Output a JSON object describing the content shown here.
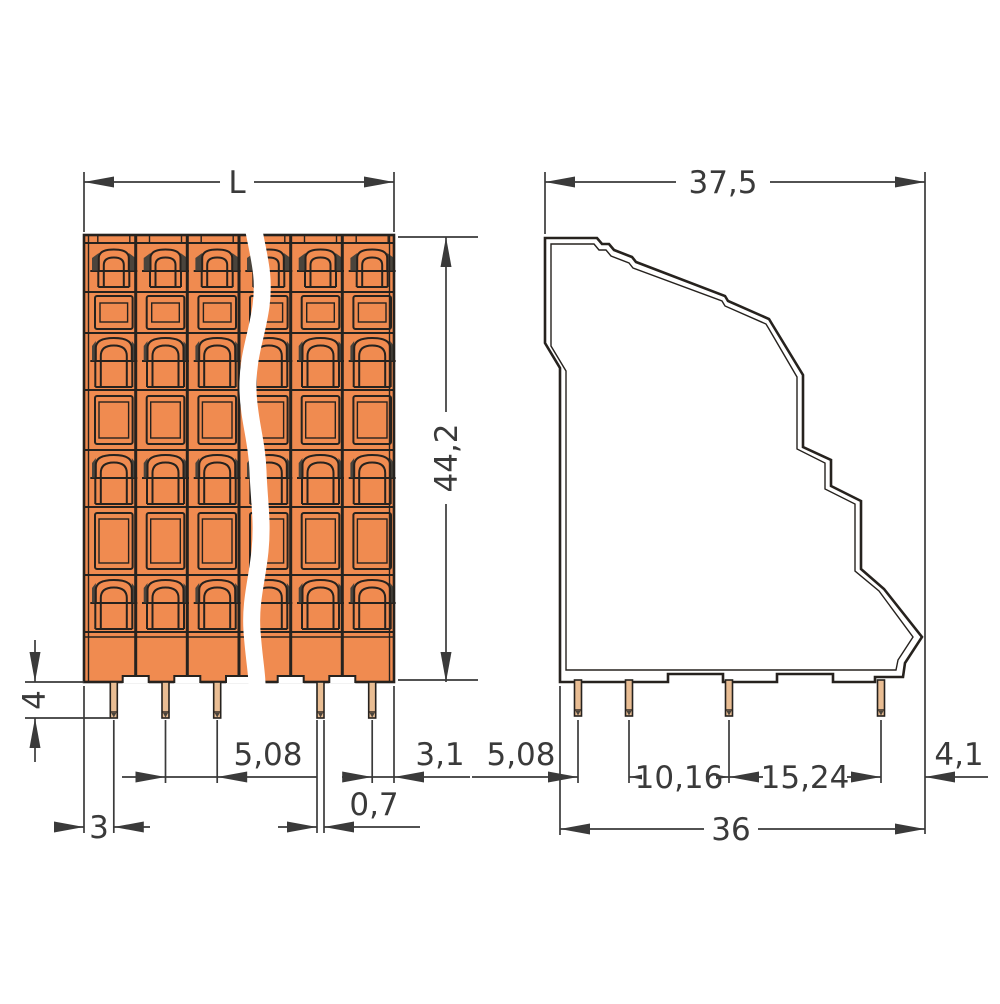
{
  "diagram": {
    "type": "technical-dimension-drawing",
    "front_view": {
      "dim_overall_width": "L",
      "dim_overall_height": "44,2",
      "dim_pin_length": "4",
      "dim_pin_pitch": "5,08",
      "dim_edge_to_pin_right": "3,1",
      "dim_pin_width": "0,7",
      "dim_edge_to_pin_left": "3"
    },
    "side_view": {
      "dim_overall_depth": "37,5",
      "dim_edge_to_pin1": "5,08",
      "dim_pin1_to_pin2": "10,16",
      "dim_pin2_to_pin3": "15,24",
      "dim_pin_to_edge_right": "4,1",
      "dim_pin_span_total": "36"
    },
    "colors": {
      "body": "#F08B50",
      "body_light": "#F6C99C",
      "slot_dark": "#4A443C",
      "pin": "#E9BD93",
      "line": "#26221E",
      "dim": "#3A3A3A"
    }
  }
}
